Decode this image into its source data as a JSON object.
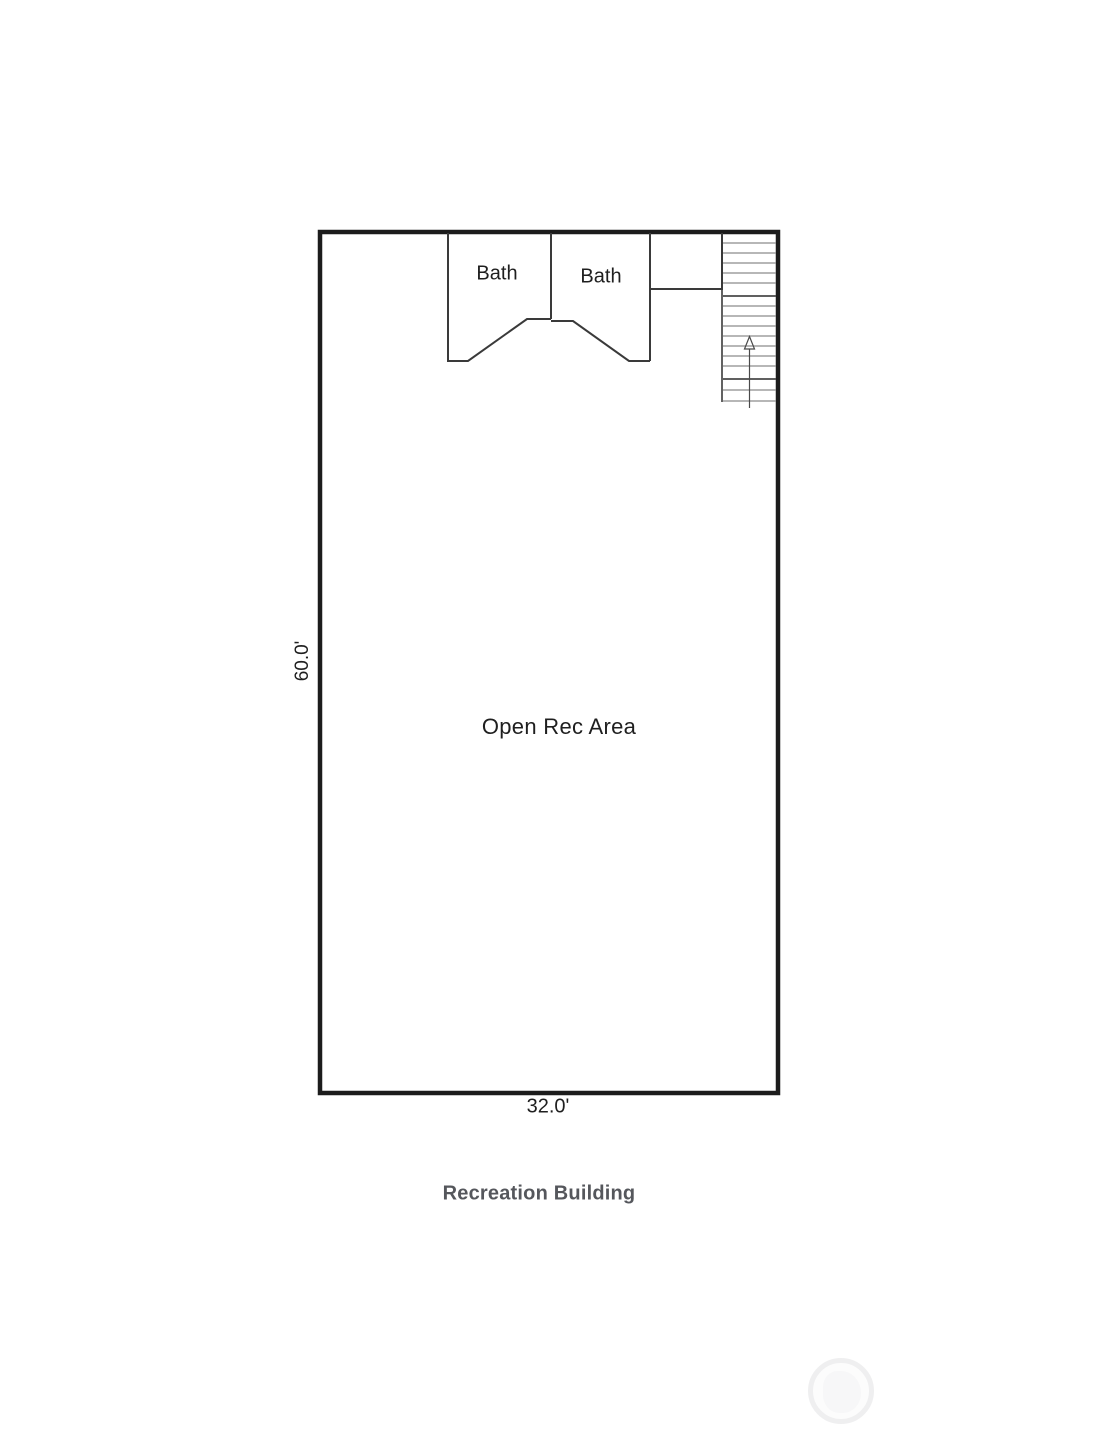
{
  "plan": {
    "room_labels": {
      "bath_left": "Bath",
      "bath_right": "Bath",
      "open_area": "Open Rec Area"
    },
    "dimensions": {
      "height": "60.0'",
      "width": "32.0'"
    },
    "caption": "Recreation Building"
  },
  "icons": {
    "staircase": "staircase-with-up-arrow",
    "watermark": "circular-logo-watermark"
  },
  "colors": {
    "wall": "#1c1c1c",
    "partition": "#3a3a3a",
    "stair": "#8c8c8c",
    "stair_dark": "#4a4a4a",
    "label": "#1f1f1f",
    "caption": "#55575c",
    "watermark": "#efeff0"
  }
}
